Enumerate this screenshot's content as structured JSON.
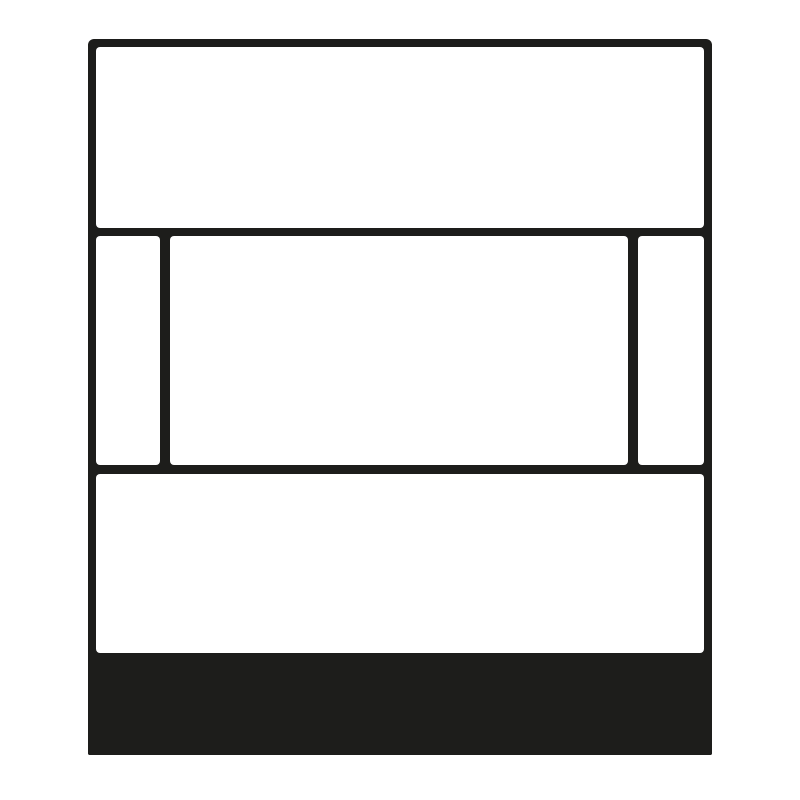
{
  "figure": {
    "kind": "schematic-line-icon",
    "description": "Abstract front-view schematic of a rectangular plate: top panel, middle row with wide center window flanked by two narrow side strips, bottom panel, and a solid filled base band at the bottom.",
    "parts": {
      "frame": "outer rounded rectangle outline",
      "panel_top": "upper white rectangle",
      "strip_left": "narrow left vertical white strip",
      "panel_center": "wide central white rectangle",
      "strip_right": "narrow right vertical white strip",
      "panel_bottom": "lower white rectangle",
      "base_band": "solid filled band at bottom of frame"
    }
  },
  "colors": {
    "ink": "#1d1d1b",
    "background": "#ffffff"
  }
}
